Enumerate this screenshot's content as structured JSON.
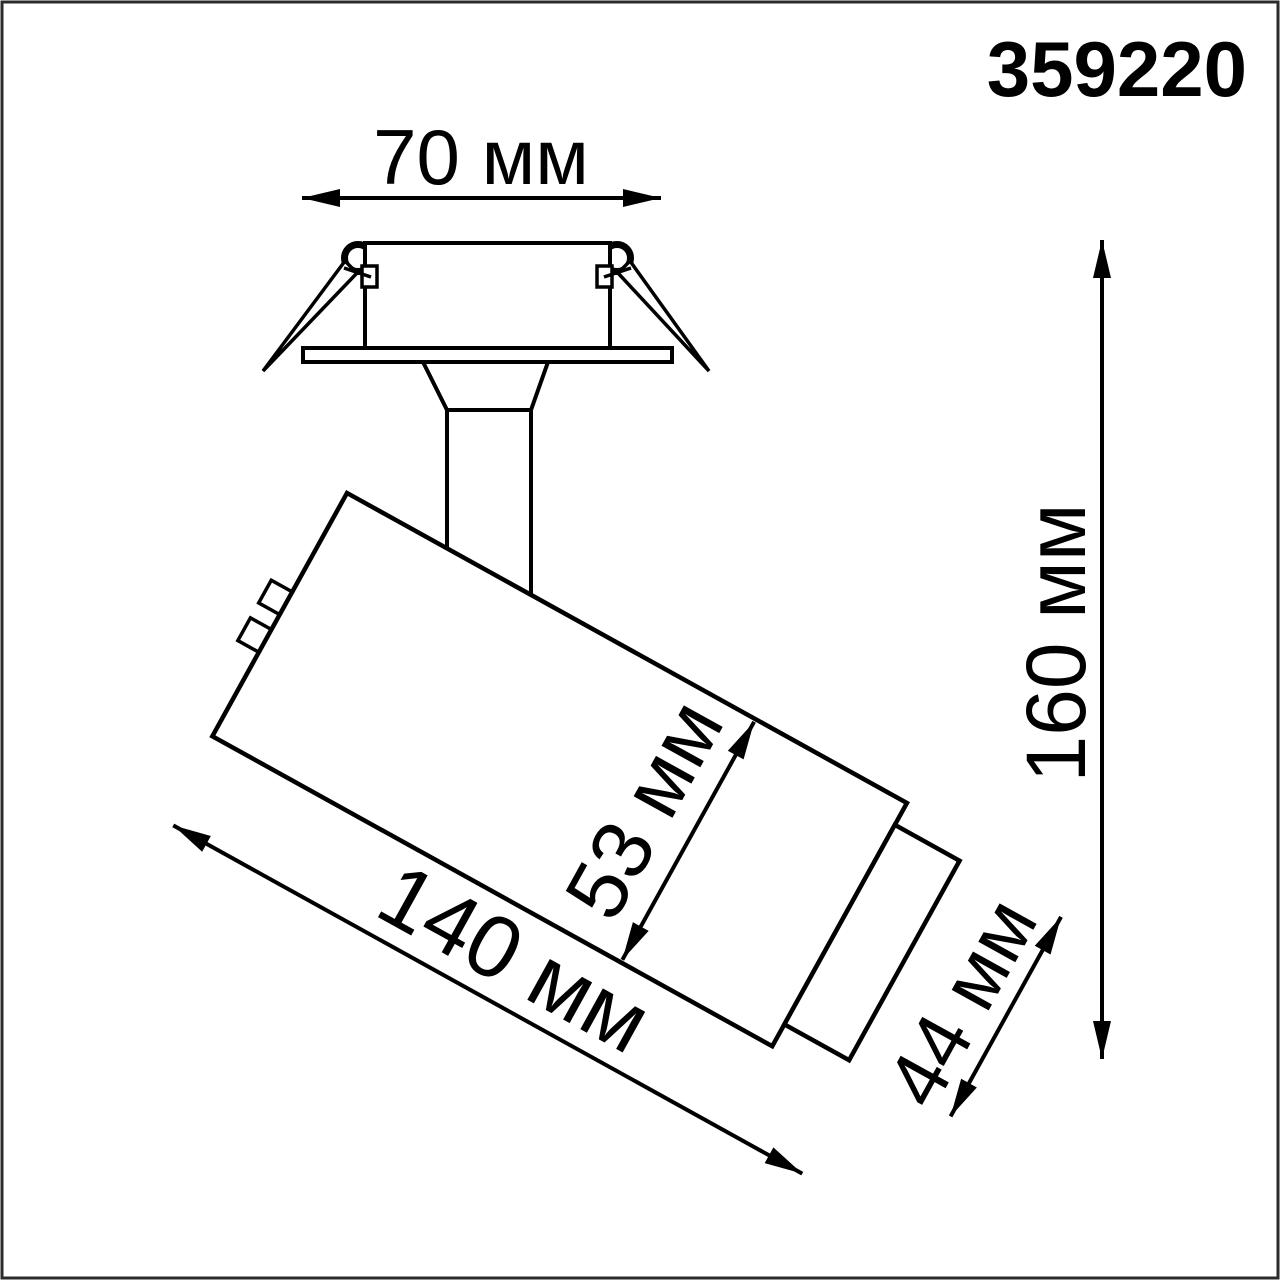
{
  "drawing": {
    "title": "Luminaire dimension drawing",
    "product_code": "359220",
    "dimensions": {
      "cutout_width": "70 мм",
      "overall_height": "160 мм",
      "body_length": "140 мм",
      "body_diameter": "53 мм",
      "head_diameter": "44 мм"
    },
    "colors": {
      "ink": "#000000",
      "background": "#ffffff",
      "frame": "#2b2b2b"
    }
  }
}
